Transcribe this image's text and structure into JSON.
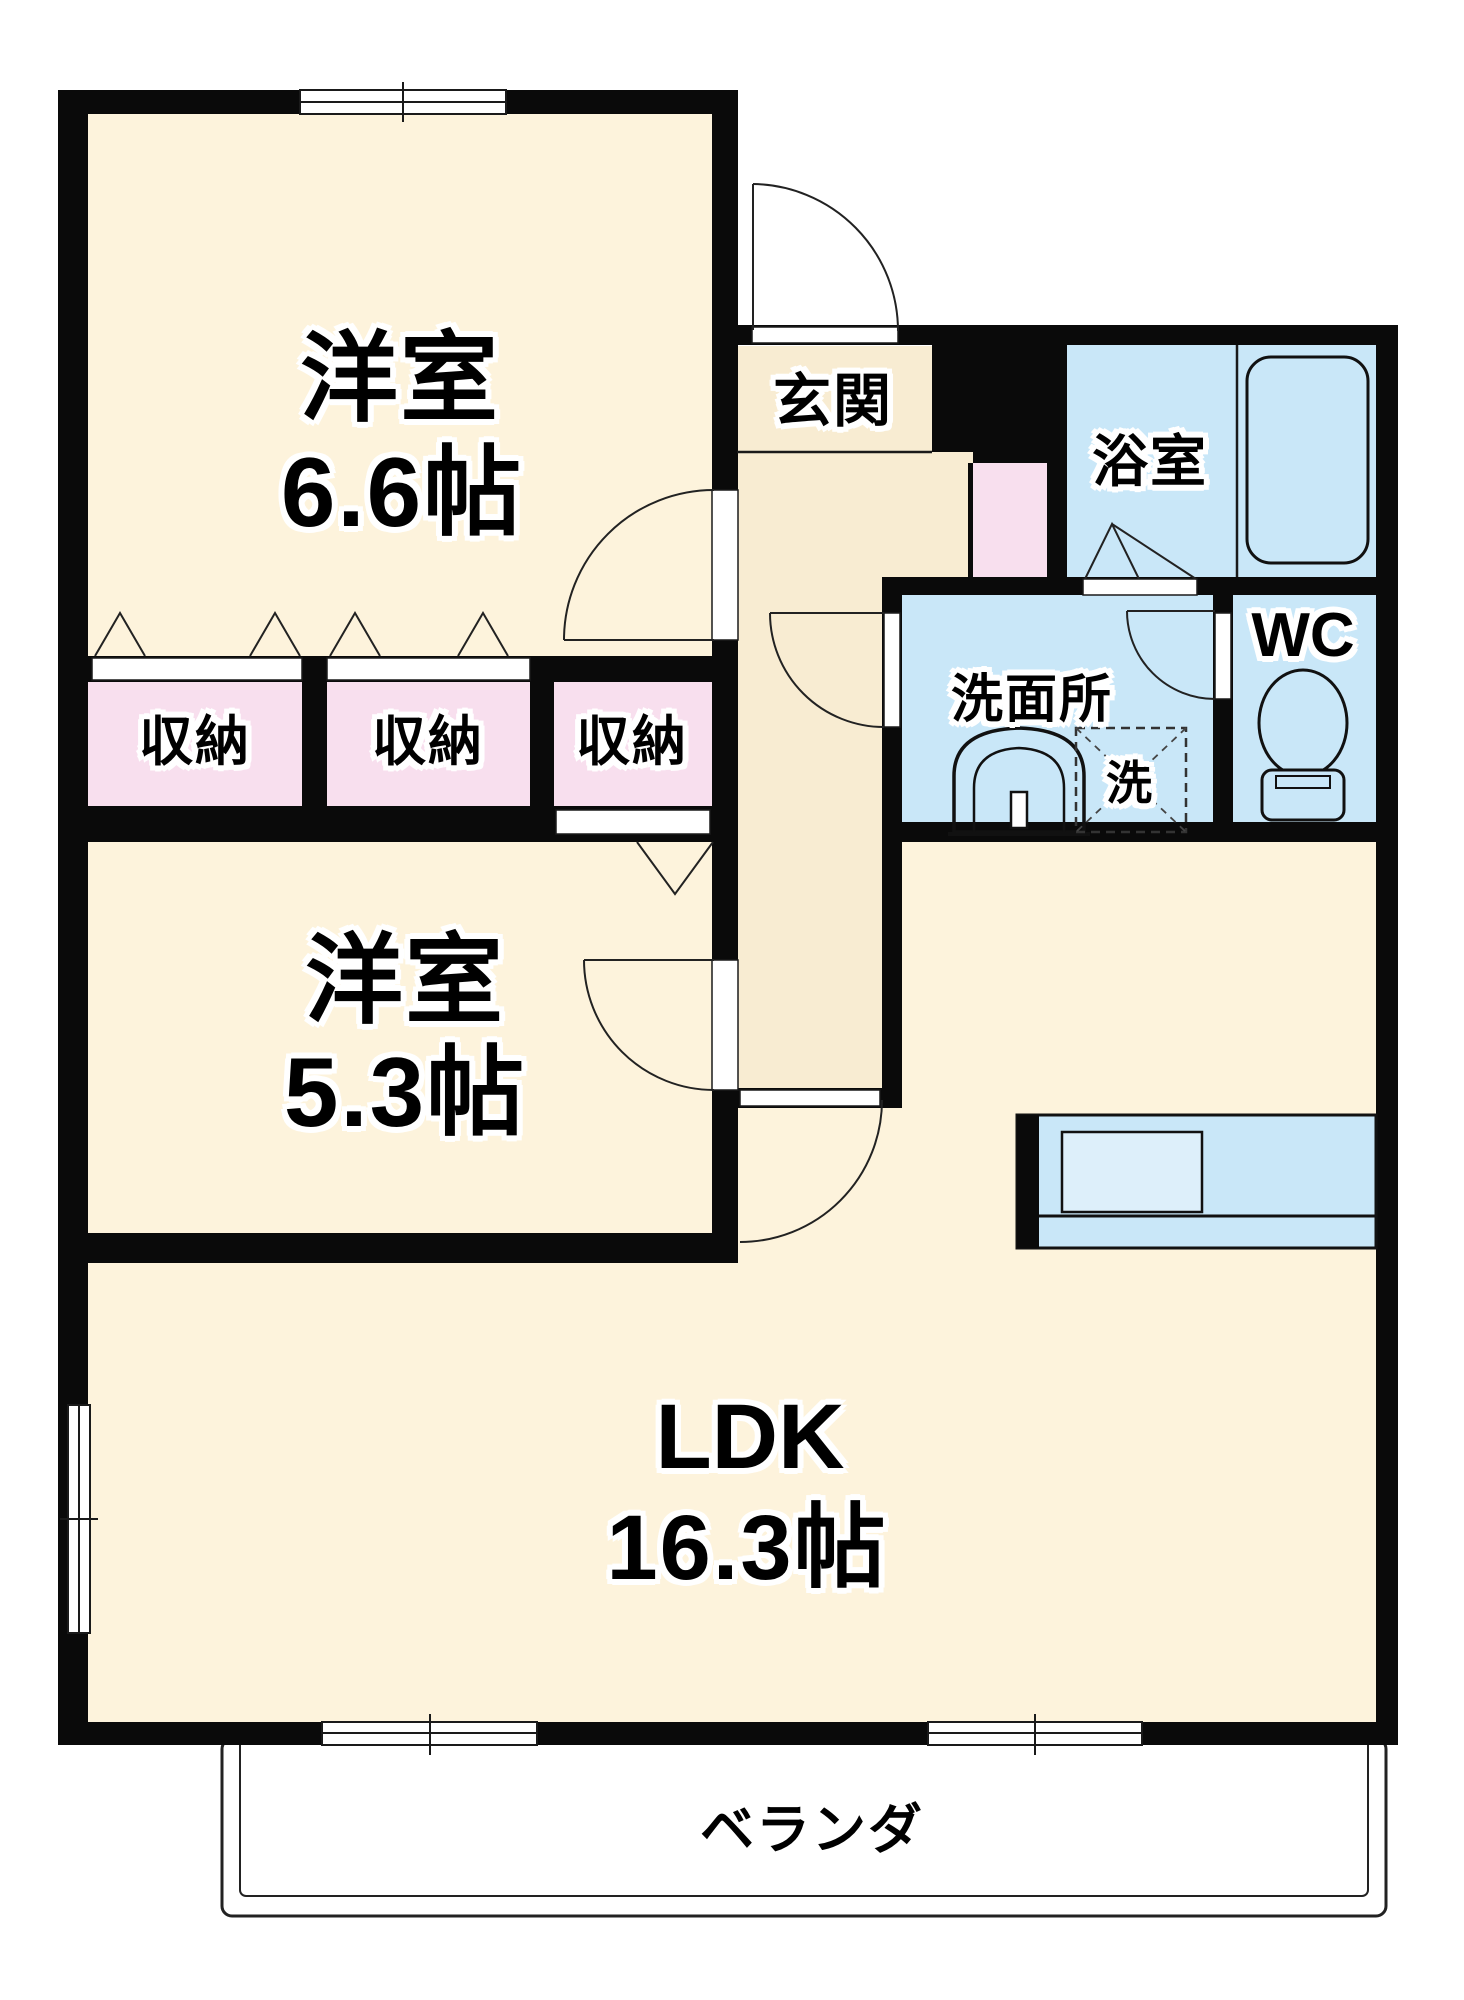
{
  "floor_plan": {
    "rooms": [
      {
        "id": "western-room-1",
        "name": "洋室",
        "size": "6.6帖"
      },
      {
        "id": "western-room-2",
        "name": "洋室",
        "size": "5.3帖"
      },
      {
        "id": "ldk",
        "name": "LDK",
        "size": "16.3帖"
      }
    ],
    "labels": {
      "entrance": "玄関",
      "bathroom": "浴室",
      "washroom": "洗面所",
      "washing_machine": "洗",
      "toilet": "WC",
      "veranda": "ベランダ",
      "storage": [
        "収納",
        "収納",
        "収納"
      ]
    },
    "colors": {
      "wall": "#0a0a0a",
      "room_floor": "#fdf3dc",
      "entry_floor": "#f8ecd2",
      "storage_floor": "#f8dfee",
      "wet_area_floor": "#c9e7f8",
      "sink_fill": "#ddeffa",
      "background": "#ffffff"
    }
  }
}
